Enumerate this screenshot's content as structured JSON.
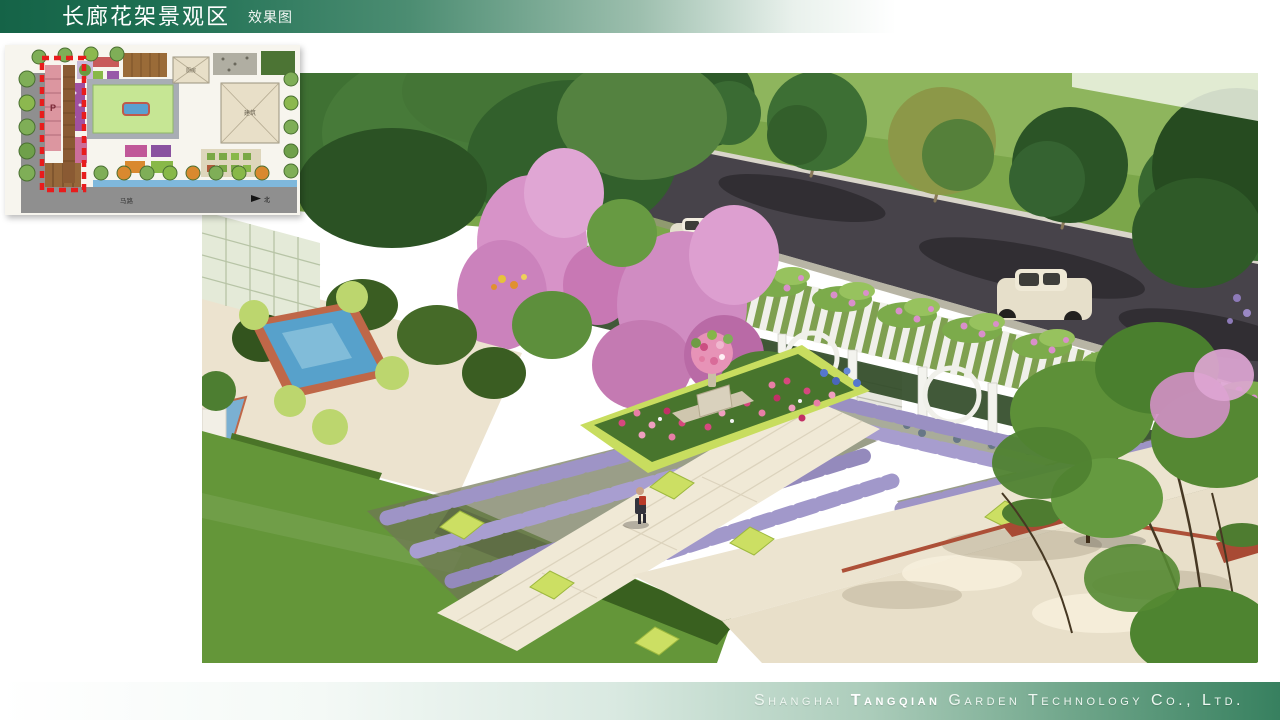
{
  "slide": {
    "header": {
      "title": "长廊花架景观区",
      "subtitle": "效果图",
      "gradient_left": "#156347",
      "gradient_right": "#ffffff"
    },
    "footer": {
      "company_prefix": "Shanghai ",
      "company_emphasis": "Tangqian",
      "company_suffix": " Garden Technology Co., Ltd.",
      "gradient_left": "#ffffff",
      "gradient_right": "#37805f"
    }
  },
  "site_plan": {
    "labels": {
      "parking": "P",
      "road": "马路",
      "north": "北",
      "building_small": "厨房",
      "building_large": "建筑"
    },
    "highlight_color": "#e81c1c"
  },
  "rendering": {
    "alt": "Aerial 3D rendering: long white trellis pergola covered with pink climbing roses beside an asphalt road with street trees; lavender parterre rows with chartreuse box squares; central rose bed with stone urn; blue reflecting pool with terracotta edge; paved walks, bench plaza, lawns and flowering trees."
  }
}
